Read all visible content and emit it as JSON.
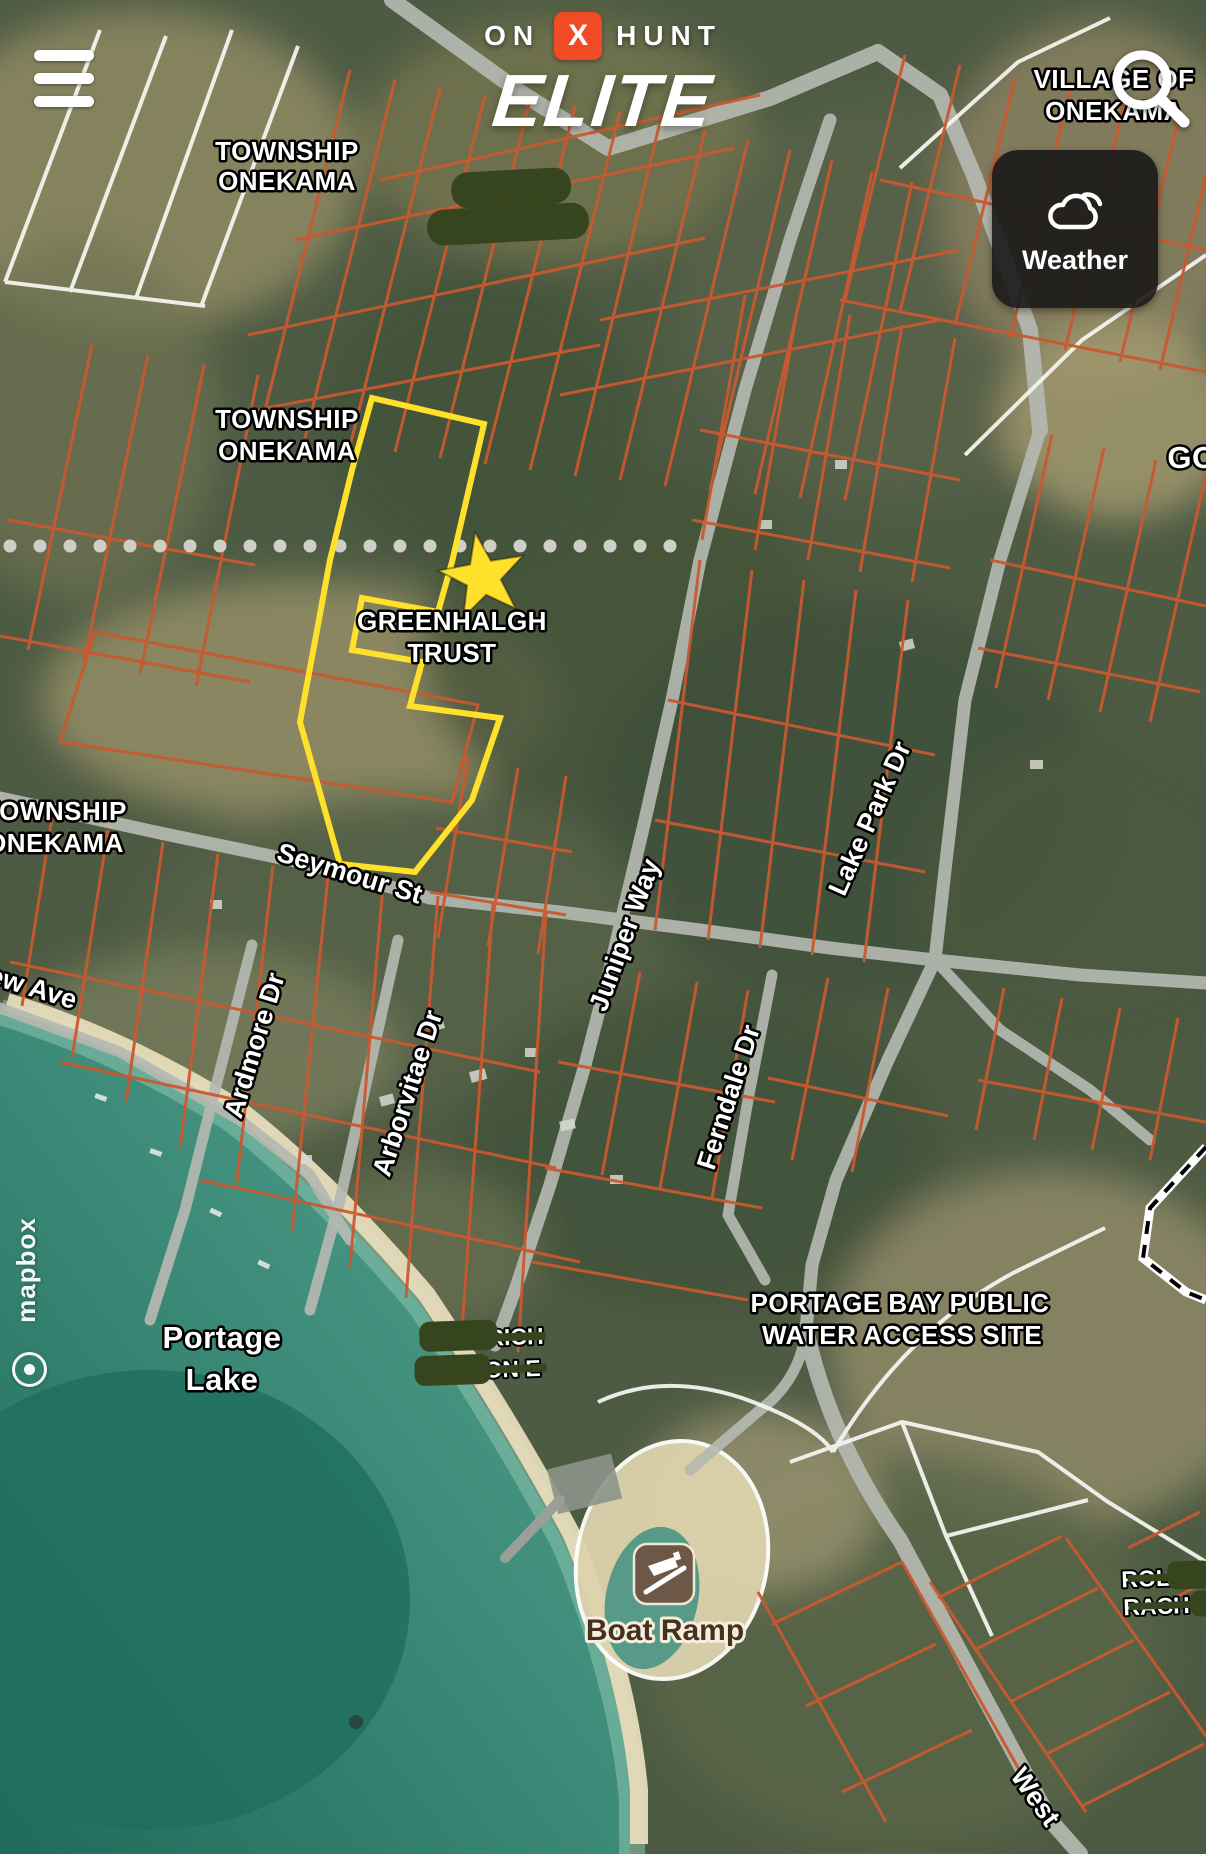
{
  "app": {
    "logo": {
      "on": "ON",
      "x": "X",
      "hunt": "HUNT",
      "tier": "ELITE"
    },
    "weather_button": {
      "label": "Weather"
    },
    "attribution": "mapbox"
  },
  "map": {
    "area_labels": {
      "township_top": {
        "line1": "TOWNSHIP",
        "line2": "ONEKAMA"
      },
      "township_mid": {
        "line1": "TOWNSHIP",
        "line2": "ONEKAMA"
      },
      "township_left": {
        "line1": "TOWNSHIP",
        "line2": "ONEKAMA"
      },
      "village": {
        "line1": "VILLAGE OF",
        "line2": "ONEKAMA"
      },
      "go_partial": "GO",
      "water_access": {
        "line1": "PORTAGE BAY PUBLIC",
        "line2": "WATER ACCESS SITE"
      },
      "lake": {
        "line1": "Portage",
        "line2": "Lake"
      }
    },
    "parcel_highlight": {
      "owner_line1": "GREENHALGH",
      "owner_line2": "TRUST"
    },
    "streets": {
      "seymour": "Seymour St",
      "ardmore": "Ardmore Dr",
      "arborvitae": "Arborvitae Dr",
      "juniper": "Juniper Way",
      "ferndale": "Ferndale Dr",
      "lakepark": "Lake Park Dr",
      "west": "West",
      "ew_ave": "ew Ave"
    },
    "poi": {
      "boat_ramp": "Boat Ramp"
    },
    "redacted_fragments": {
      "owner1_line1": "RICH",
      "owner1_line2": "ON E",
      "owner2_line1": "ROL",
      "owner2_line2": "RACH"
    },
    "colors": {
      "parcel_line": "#c9582f",
      "highlight_parcel": "#ffe12b",
      "redaction_green": "#36451d",
      "onx_orange": "#f04b25",
      "road_gray": "#b5b9b1",
      "water_teal": "#2e7f6d",
      "weather_bg": "#1e1e1e"
    }
  }
}
